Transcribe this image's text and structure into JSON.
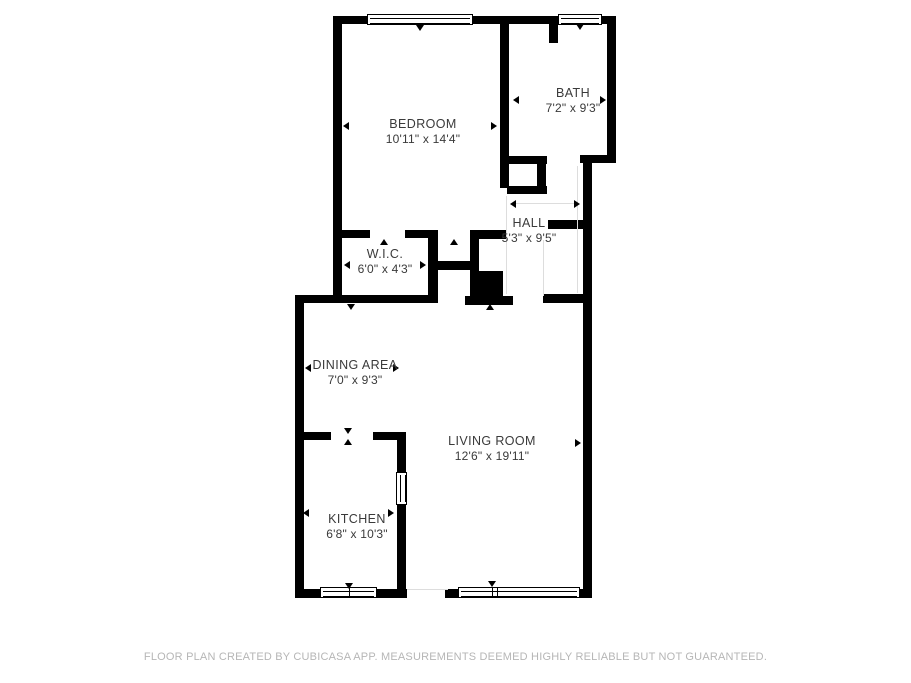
{
  "plan": {
    "title": "Apartment floor plan",
    "rooms": [
      {
        "id": "bedroom",
        "name": "BEDROOM",
        "dims": "10'11\" x 14'4\""
      },
      {
        "id": "bath",
        "name": "BATH",
        "dims": "7'2\" x 9'3\""
      },
      {
        "id": "hall",
        "name": "HALL",
        "dims": "5'3\" x 9'5\""
      },
      {
        "id": "wic",
        "name": "W.I.C.",
        "dims": "6'0\" x 4'3\""
      },
      {
        "id": "dining",
        "name": "DINING AREA",
        "dims": "7'0\" x 9'3\""
      },
      {
        "id": "living",
        "name": "LIVING ROOM",
        "dims": "12'6\" x 19'11\""
      },
      {
        "id": "kitchen",
        "name": "KITCHEN",
        "dims": "6'8\" x 10'3\""
      }
    ],
    "footer": "FLOOR PLAN CREATED BY CUBICASA APP. MEASUREMENTS DEEMED HIGHLY RELIABLE BUT NOT GUARANTEED.",
    "colors": {
      "wall": "#000000",
      "background": "#ffffff",
      "label_text": "#3a3a3a",
      "footer_text": "#b6b6b6",
      "faint_line": "#dddddd"
    }
  }
}
